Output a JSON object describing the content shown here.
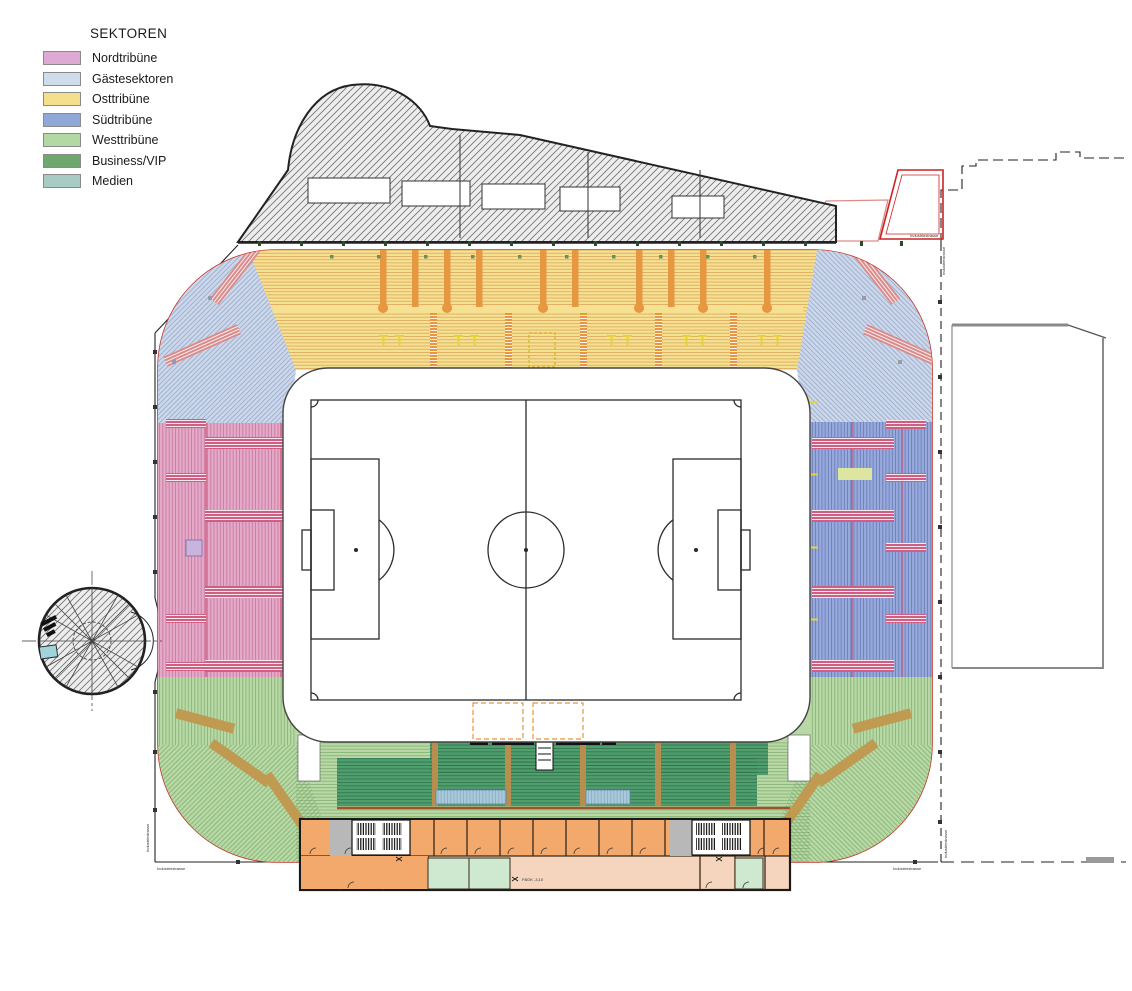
{
  "legend": {
    "title": "SEKTOREN",
    "items": [
      {
        "label": "Nordtribüne",
        "color": "#dcaad2"
      },
      {
        "label": "Gästesektoren",
        "color": "#cedcec"
      },
      {
        "label": "Osttribüne",
        "color": "#f4e08c"
      },
      {
        "label": "Südtribüne",
        "color": "#90a8d8"
      },
      {
        "label": "Westtribüne",
        "color": "#b4d8a4"
      },
      {
        "label": "Business/VIP",
        "color": "#6ea86e"
      },
      {
        "label": "Medien",
        "color": "#a8ccc4"
      }
    ]
  },
  "plan": {
    "labels": {
      "level": "FBOK -3,10",
      "street_bottom_left": "Industriestrasse",
      "street_bottom_right": "Industriestrasse",
      "street_left": "Industriestrasse",
      "street_right_top": "Industriestrasse",
      "street_right_bottom": "Industriestrasse",
      "parcel": "Industriestrasse"
    },
    "colors": {
      "bowl_outline_red": "#c0392b",
      "north_stand_pink": "#e3aac6",
      "guest_sector_lightblue": "#ccd8ea",
      "east_stand_yellow": "#f6e193",
      "south_stand_blue": "#97a9d9",
      "west_stand_green": "#b8d8a6",
      "business_vip_darkgreen": "#4f9e6e",
      "media_desk_teal": "#a9cbd8",
      "stair_orange": "#e6973f",
      "stair_red": "#cf5f82",
      "stair_tan": "#c09a50",
      "building_orange_room": "#f2a96b",
      "building_corridor_tan": "#f5d5bd",
      "building_green_room": "#cfe8d0",
      "pitch_line": "#2b2b2b",
      "boundary_black": "#222222",
      "neighbor_gray": "#8a8a8a",
      "parcel_red": "#cc2222"
    },
    "icons": {
      "spiral_ramp": "spiral-ramp-icon",
      "floodlight": "floodlight-icon",
      "stairs": "stairs-icon",
      "players_tunnel": "tunnel-icon",
      "bench_box": "bench-box-icon"
    }
  }
}
